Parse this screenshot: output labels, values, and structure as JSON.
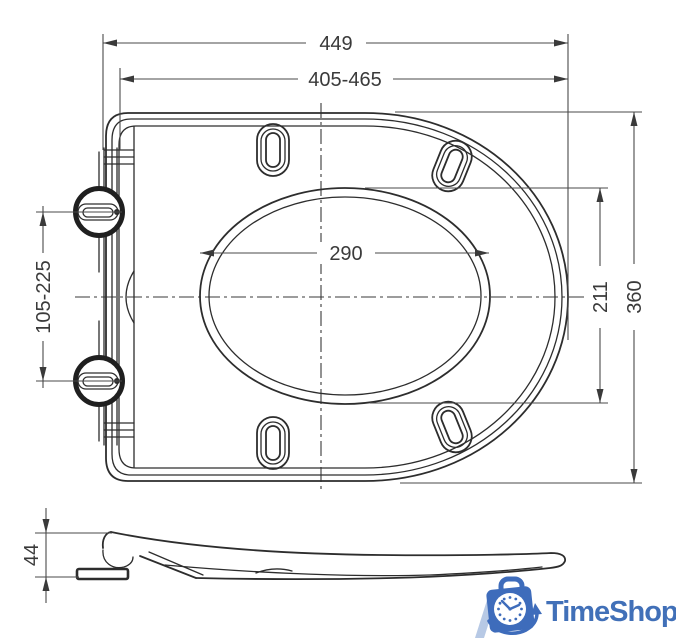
{
  "drawing": {
    "type": "technical-dimension-drawing",
    "subject": "slim toilet seat, top view and side profile",
    "dimensions": {
      "total_length": "449",
      "mounting_range": "405-465",
      "inner_length": "290",
      "inner_width": "211",
      "overall_width": "360",
      "hinge_span_range": "105-225",
      "profile_height": "44"
    },
    "colors": {
      "line": "#2d2d2d",
      "dim_line": "#4a4a4a",
      "background": "#ffffff"
    }
  },
  "logo": {
    "text": "TimeShop",
    "text_color": "#4170b8",
    "icon_color": "#3e6cbb",
    "stripe_color": "#b7c9e5",
    "icon": "clock-shopping-bag"
  }
}
